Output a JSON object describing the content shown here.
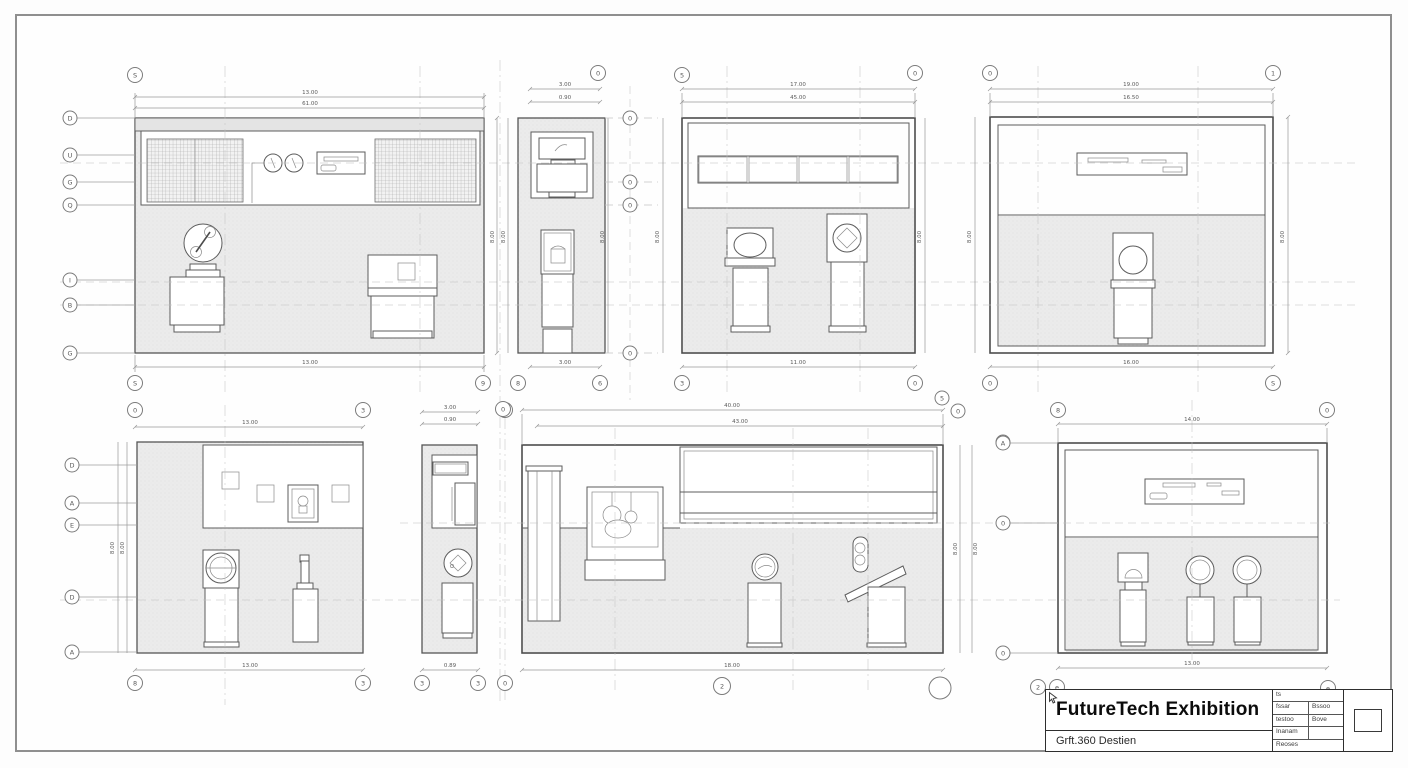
{
  "sheet": {
    "background": "#fefefe",
    "border_color": "#8f8f8f"
  },
  "title_block": {
    "title": "FutureTech Exhibition",
    "subtitle": "Grft.360 Destien",
    "table": {
      "r1c1": "ts",
      "r2c1": "fssar",
      "r2c2": "Bssoo",
      "r3c1": "testoo",
      "r3c2": "Bove",
      "r4c1": "Inanam",
      "r5c1": "Reoses"
    },
    "stamp_icon": "cursor-arrow"
  },
  "views": [
    {
      "id": "elevation-top-left",
      "dims": {
        "top_outer": "13.00",
        "top_inner": "61.00",
        "bottom": "13.00",
        "right": "8.00"
      },
      "bubbles": {
        "top": "S",
        "bottom_left": "S",
        "bottom_right": "9",
        "left": [
          "D",
          "U",
          "G",
          "Q",
          "I",
          "B",
          "G"
        ]
      }
    },
    {
      "id": "elevation-top-narrow",
      "dims": {
        "top_outer": "3.00",
        "top_inner": "0.90",
        "bottom": "3.00",
        "left": "8.00",
        "right": "8.00",
        "outer_right": "8.00"
      },
      "bubbles": {
        "top": "0",
        "bottom_left": "8",
        "bottom_right": "6",
        "right": [
          "0",
          "0",
          "0",
          "0"
        ]
      }
    },
    {
      "id": "elevation-top-mid",
      "dims": {
        "top_outer": "17.00",
        "top_inner": "45.00",
        "bottom": "11.00",
        "right": "8.00"
      },
      "bubbles": {
        "top_left": "5",
        "top_right": "0",
        "bottom_left": "3",
        "bottom_right": "0"
      }
    },
    {
      "id": "elevation-top-right",
      "dims": {
        "top_outer": "19.00",
        "top_inner": "16.50",
        "bottom": "16.00",
        "left": "8.00",
        "right": "8.00"
      },
      "bubbles": {
        "top_left": "0",
        "top_right": "1",
        "bottom_left": "0",
        "bottom_right": "S"
      }
    },
    {
      "id": "elevation-bottom-left",
      "dims": {
        "top": "13.00",
        "bottom": "13.00",
        "left_outer": "8.00",
        "left_inner": "8.00"
      },
      "bubbles": {
        "top_left": "0",
        "top_right": "3",
        "bottom_left": "8",
        "bottom_right": "3",
        "left": [
          "D",
          "A",
          "E",
          "D",
          "A"
        ]
      }
    },
    {
      "id": "elevation-bottom-narrow",
      "dims": {
        "top_outer": "3.00",
        "top_inner": "0.90",
        "bottom": "0.89"
      },
      "bubbles": {
        "top": "0",
        "bottom_left": "3",
        "bottom_right": "3",
        "bottom_outer": "0"
      }
    },
    {
      "id": "elevation-bottom-mid",
      "dims": {
        "top_outer": "40.00",
        "top_inner": "43.00",
        "bottom": "18.00",
        "right_outer": "8.00",
        "right_inner": "8.00"
      },
      "bubbles": {
        "bottom": "2"
      }
    },
    {
      "id": "elevation-bottom-right",
      "dims": {
        "top": "14.00",
        "bottom": "13.00"
      },
      "bubbles": {
        "top_left": "8",
        "top_right": "0",
        "left": [
          "A",
          "0",
          "0"
        ],
        "bottom": [
          "2",
          "e",
          "e"
        ]
      }
    }
  ],
  "loose_bubbles": [
    "5",
    "0",
    "D",
    "A"
  ]
}
